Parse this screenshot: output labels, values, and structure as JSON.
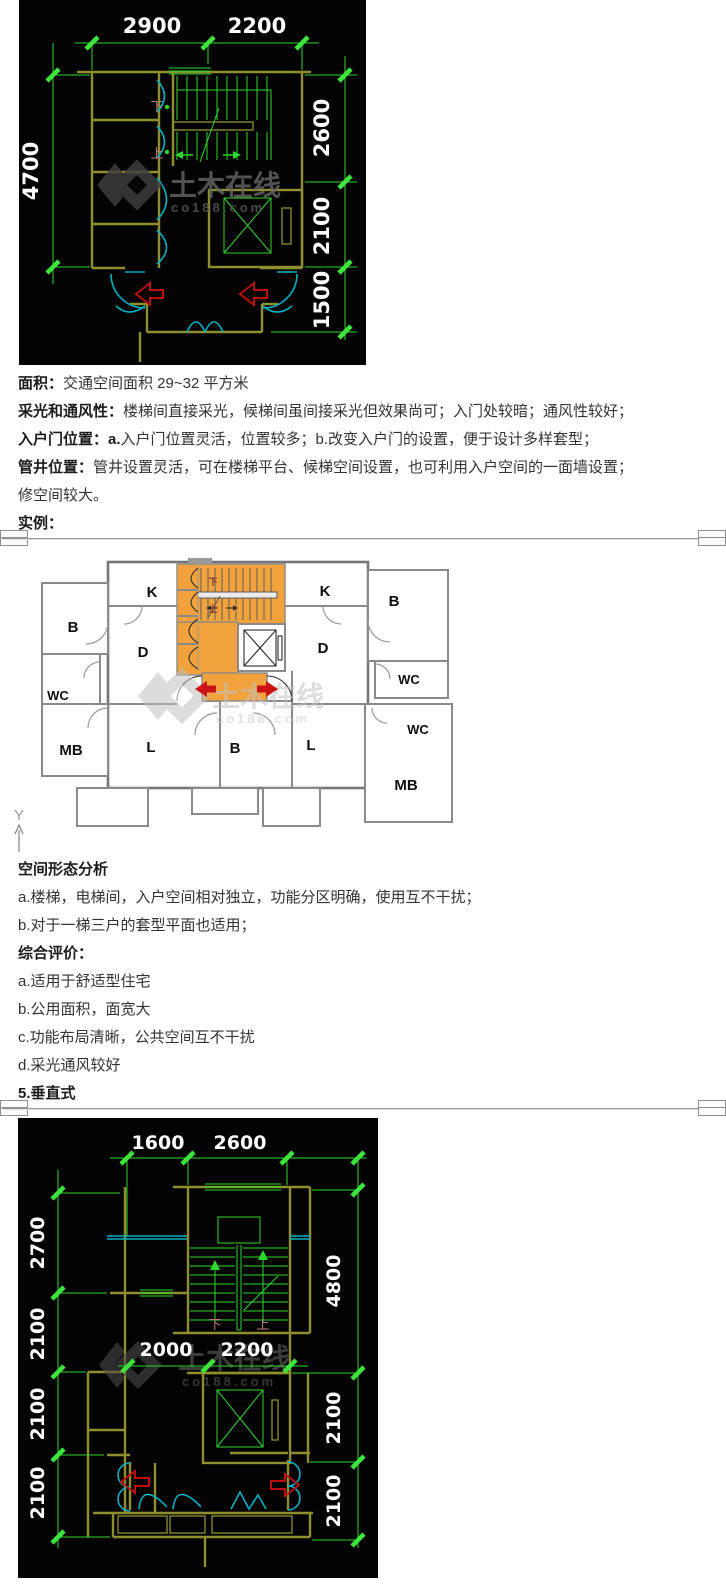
{
  "palette": {
    "dim_green": "#2bd82b",
    "wall_olive": "#8f8f2e",
    "door_cyan": "#00b0c4",
    "arrow_red": "#cc1414",
    "core_orange": "#f2a23c",
    "plan_wall_gray": "#8a8a8a"
  },
  "watermark": {
    "brand": "土木在线",
    "domain": "co188.com"
  },
  "plan1": {
    "dim_top": [
      "2900",
      "2200"
    ],
    "dim_left": [
      "4700"
    ],
    "dim_right": [
      "2600",
      "2100",
      "1500"
    ],
    "stair_down": "下",
    "stair_up": "上"
  },
  "text1": {
    "l1_label": "面积：",
    "l1": "交通空间面积 29~32 平方米",
    "l2_label": "采光和通风性：",
    "l2": "楼梯间直接采光，候梯间虽间接采光但效果尚可；入门处较暗；通风性较好；",
    "l3_label": "入户门位置：",
    "l3_sub": "a.",
    "l3": "入户门位置灵活，位置较多；b.改变入户门的设置，便于设计多样套型；",
    "l4_label": "管井位置：",
    "l4": "管井设置灵活，可在楼梯平台、候梯空间设置，也可利用入户空间的一面墙设置；",
    "l5": "修空间较大。",
    "l6_label": "实例："
  },
  "plan2": {
    "axis_label": "Y",
    "stair_down": "下",
    "stair_up": "上",
    "rooms": {
      "k_left": "K",
      "b_topleft": "B",
      "d_left": "D",
      "wc_left": "WC",
      "mb_left": "MB",
      "l_left": "L",
      "b_center": "B",
      "k_right": "K",
      "b_topright": "B",
      "d_right": "D",
      "wc_right_upper": "WC",
      "wc_right_lower": "WC",
      "l_right": "L",
      "mb_right": "MB"
    }
  },
  "text2": {
    "h1": "空间形态分析",
    "a1": "a.楼梯，电梯间，入户空间相对独立，功能分区明确，使用互不干扰；",
    "a2": "b.对于一梯三户的套型平面也适用；",
    "h2": "综合评价：",
    "b1": "a.适用于舒适型住宅",
    "b2": "b.公用面积，面宽大",
    "b3": "c.功能布局清晰，公共空间互不干扰",
    "b4": "d.采光通风较好",
    "h3": "5.垂直式"
  },
  "plan3": {
    "dim_top": [
      "1600",
      "2600"
    ],
    "dim_left": [
      "2700",
      "2100",
      "2100",
      "2100"
    ],
    "dim_right": [
      "4800",
      "2100",
      "2100"
    ],
    "dim_mid": [
      "2000",
      "2200"
    ],
    "stair_down": "下",
    "stair_up": "上"
  }
}
